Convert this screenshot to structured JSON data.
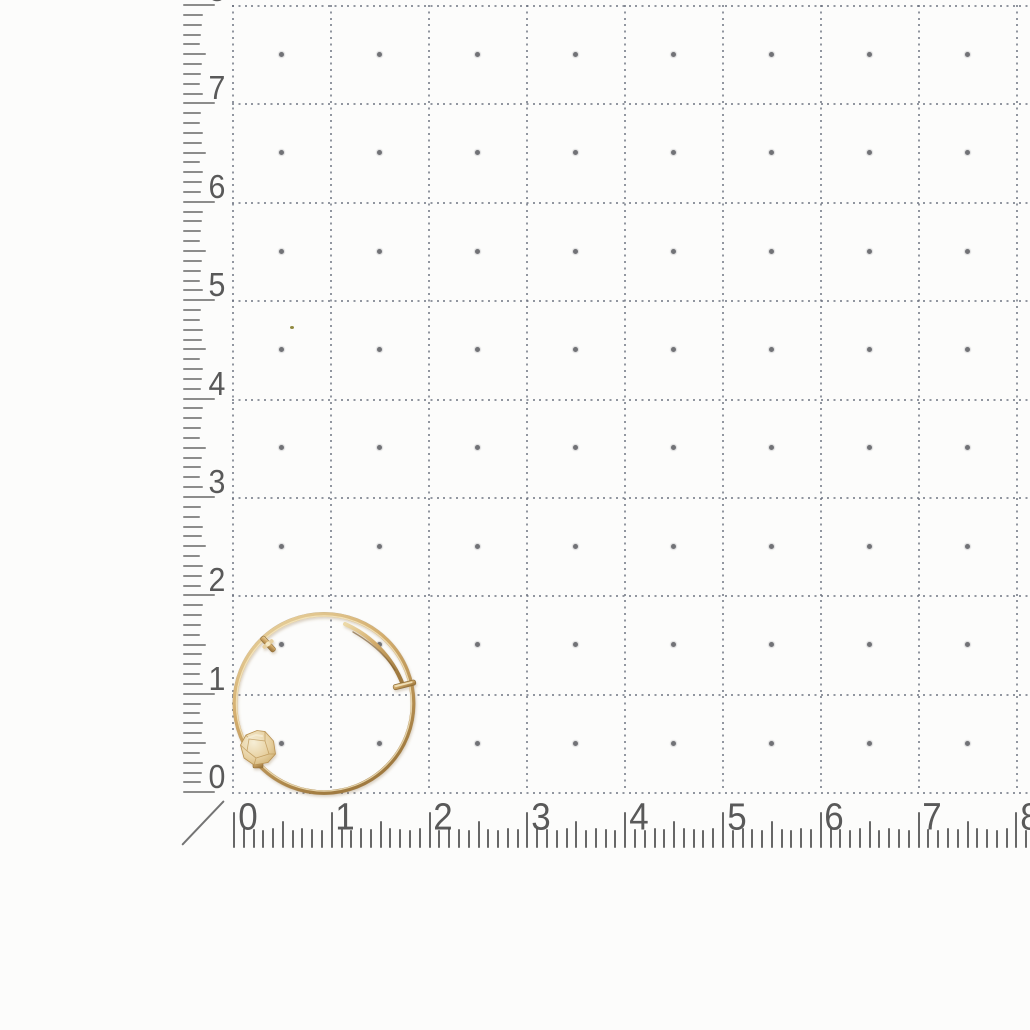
{
  "scene": {
    "subject": "gold hoop earring photographed on dotted grid measuring paper",
    "background_color": "#fcfcfb"
  },
  "grid": {
    "unit_min": 0,
    "unit_max": 8,
    "columns": 8,
    "rows": 8,
    "line_color": "rgba(104,110,124,0.72)",
    "dot_color": "#4b4c52"
  },
  "left_ruler": {
    "labels": [
      "8",
      "7",
      "6",
      "5",
      "4",
      "3",
      "2",
      "1",
      "0"
    ],
    "tick_color": "#6f6f6f",
    "number_color": "#4c4c4c"
  },
  "bottom_ruler": {
    "labels": [
      "0",
      "1",
      "2",
      "3",
      "4",
      "5",
      "6",
      "7",
      "8"
    ],
    "tick_color": "#525252",
    "number_color": "#4c4c4c"
  },
  "earring": {
    "name": "gold hoop earring with faceted bead, hinge clasp and latch wire",
    "gold_light": "#ecd9a8",
    "gold_main": "#d3ac6c",
    "gold_dark": "#a07a3f",
    "gold_edge": "#8f6e39",
    "highlight": "#f5e9c4",
    "bead_bright": "#f6eed6",
    "bead_mid": "#e7d0a0",
    "bead_dark": "#c9a866",
    "facet_line": "#b89151",
    "crease": "#7d5c30"
  }
}
